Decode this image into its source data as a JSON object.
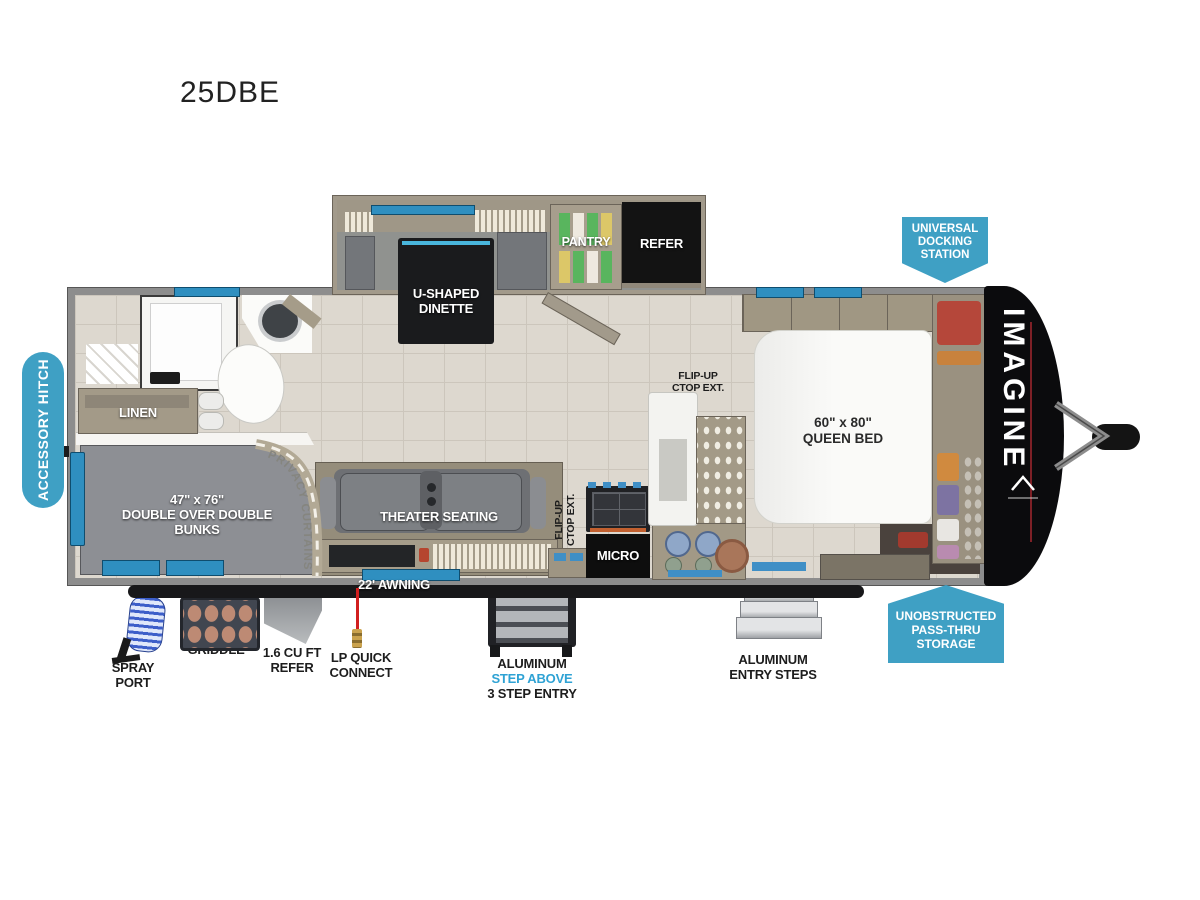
{
  "title": "25DBE",
  "floorplan": {
    "dinette": {
      "l1": "U-SHAPED",
      "l2": "DINETTE"
    },
    "pantry": {
      "label": "PANTRY"
    },
    "refer": {
      "label": "REFER"
    },
    "queen_bed": {
      "size": "60\" x 80\"",
      "label": "QUEEN BED"
    },
    "bunks": {
      "size": "47\" x 76\"",
      "l1": "DOUBLE OVER DOUBLE",
      "l2": "BUNKS"
    },
    "linen": {
      "label": "LINEN"
    },
    "theater": {
      "label": "THEATER SEATING"
    },
    "micro": {
      "label": "MICRO"
    },
    "flip_up_ctop": {
      "l1": "FLIP-UP",
      "l2": "CTOP EXT."
    },
    "privacy_curtains": {
      "label": "PRIVACY CURTAINS"
    },
    "awning": {
      "label": "22' AWNING"
    },
    "brand": {
      "label": "IMAGINE"
    }
  },
  "badges": {
    "accessory_hitch": "ACCESSORY HITCH",
    "universal_docking": {
      "l1": "UNIVERSAL",
      "l2": "DOCKING",
      "l3": "STATION"
    },
    "pass_thru": {
      "l1": "UNOBSTRUCTED",
      "l2": "PASS-THRU",
      "l3": "STORAGE"
    }
  },
  "exterior": {
    "spray_port": {
      "l1": "SPRAY",
      "l2": "PORT"
    },
    "griddle": {
      "label": "GRIDDLE"
    },
    "ext_refer": {
      "l1": "1.6 CU FT",
      "l2": "REFER"
    },
    "lp_quick_connect": {
      "l1": "LP QUICK",
      "l2": "CONNECT"
    },
    "step_entry": {
      "l1": "ALUMINUM",
      "l2": "STEP ABOVE",
      "l3": "3 STEP ENTRY"
    },
    "entry_steps": {
      "l1": "ALUMINUM",
      "l2": "ENTRY STEPS"
    }
  },
  "colors": {
    "badge_blue": "#3fa0c4",
    "window_blue": "#2f8fc0",
    "step_above_blue": "#2ea2d4",
    "front_cap_black": "#0b0b0d",
    "wall_gray": "#8d8d8d"
  }
}
